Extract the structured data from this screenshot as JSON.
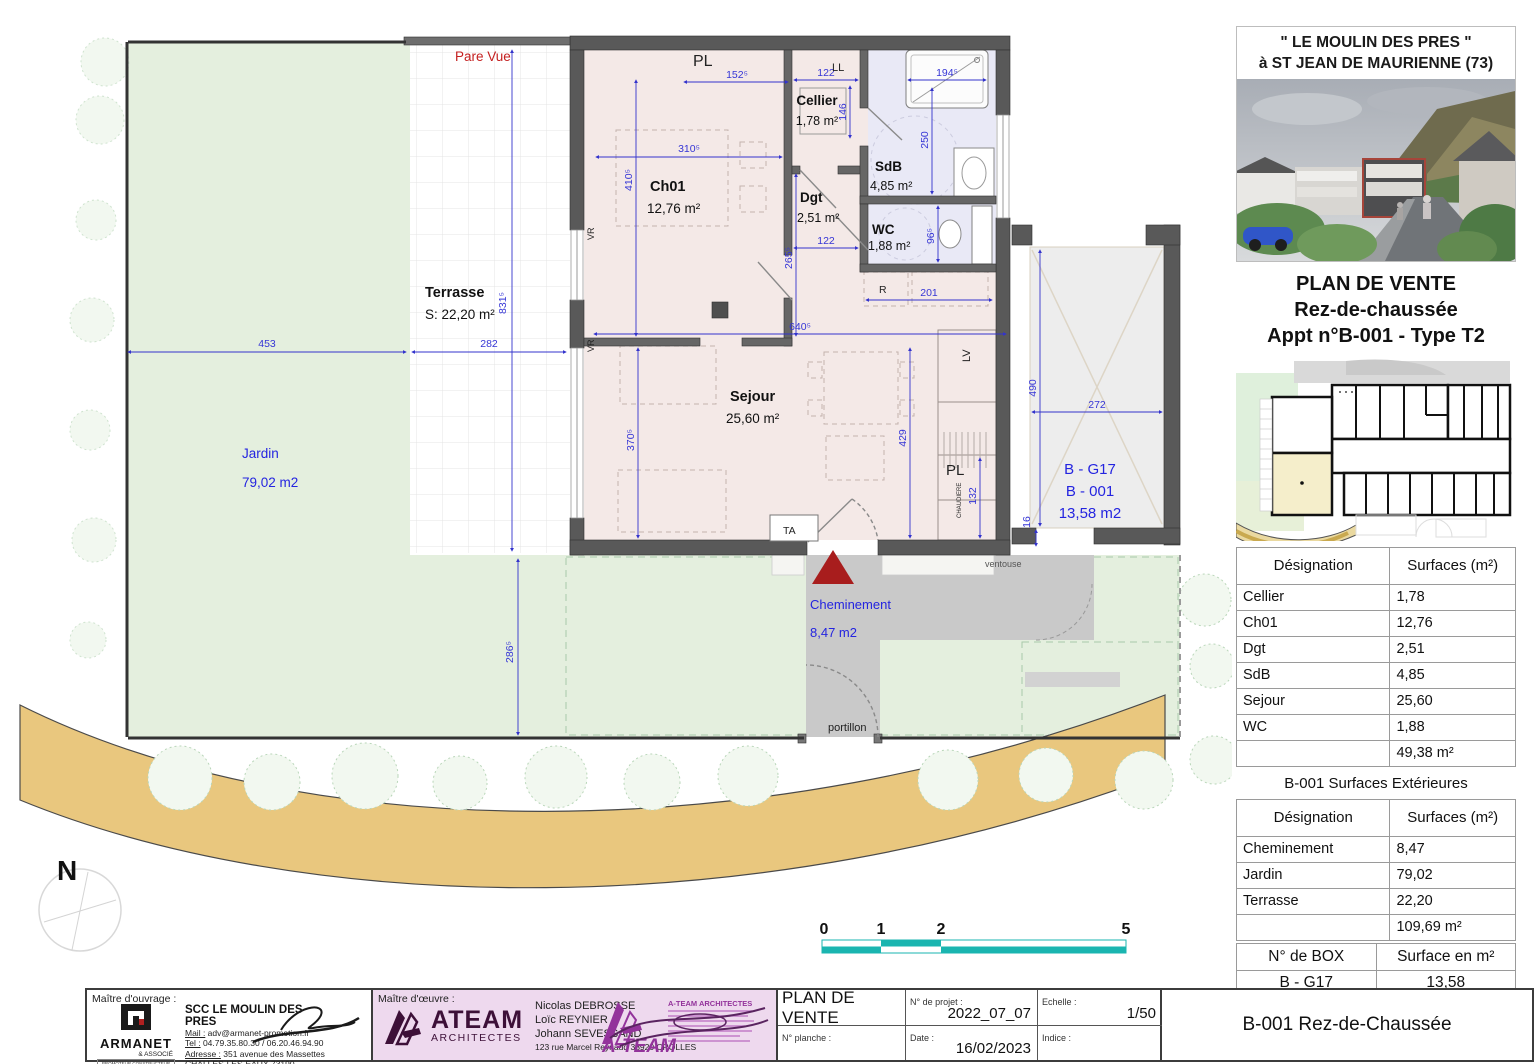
{
  "project": {
    "title_line1": "\" LE MOULIN DES PRES \"",
    "title_line2": "à ST JEAN DE MAURIENNE (73)",
    "doc_line1": "PLAN DE VENTE",
    "doc_line2": "Rez-de-chaussée",
    "doc_line3": "Appt n°B-001 - Type T2"
  },
  "plan": {
    "rooms": {
      "terrasse": {
        "name": "Terrasse",
        "area": "S: 22,20 m²"
      },
      "jardin": {
        "name": "Jardin",
        "area": "79,02 m2"
      },
      "ch01": {
        "name": "Ch01",
        "area": "12,76 m²"
      },
      "cellier": {
        "name": "Cellier",
        "area": "1,78 m²"
      },
      "dgt": {
        "name": "Dgt",
        "area": "2,51 m²"
      },
      "sdb": {
        "name": "SdB",
        "area": "4,85 m²"
      },
      "wc": {
        "name": "WC",
        "area": "1,88 m²"
      },
      "sejour": {
        "name": "Sejour",
        "area": "25,60 m²"
      },
      "box": {
        "line1": "B - G17",
        "line2": "B - 001",
        "line3": "13,58 m2"
      },
      "cheminement": {
        "name": "Cheminement",
        "area": "8,47 m2"
      }
    },
    "dims": {
      "jardin_w": "453",
      "terrasse_w": "282",
      "terrasse_h": "831⁵",
      "jardin_h2": "286⁵",
      "pl_w": "152⁵",
      "cellier_w": "122",
      "cellier_h": "146",
      "shower_w": "194⁵",
      "sdb_h": "250",
      "ch01_w": "310⁵",
      "ch01_h": "410⁵",
      "dgt_h": "265⁵",
      "dgt_w": "122",
      "wc_h": "96⁵",
      "wc_w": "201",
      "sejour_w": "640⁵",
      "sejour_h": "370⁵",
      "kitchen_h": "429",
      "kitchen_pl": "132",
      "box_h": "490",
      "box_w": "272",
      "box_gap": "16"
    },
    "misc": {
      "pare_vue": "Pare Vue",
      "pl": "PL",
      "ll": "LL",
      "lv": "LV",
      "r": "R",
      "ta": "TA",
      "vr": "VR",
      "chaudiere": "CHAUDIERE",
      "ventouse": "ventouse",
      "portillon": "portillon",
      "north": "N"
    },
    "scalebar": {
      "t0": "0",
      "t1": "1",
      "t2": "2",
      "t3": "5"
    }
  },
  "tables": {
    "interior": {
      "headers": [
        "Désignation",
        "Surfaces (m²)"
      ],
      "rows": [
        [
          "Cellier",
          "1,78"
        ],
        [
          "Ch01",
          "12,76"
        ],
        [
          "Dgt",
          "2,51"
        ],
        [
          "SdB",
          "4,85"
        ],
        [
          "Sejour",
          "25,60"
        ],
        [
          "WC",
          "1,88"
        ]
      ],
      "total": "49,38 m²"
    },
    "exterior_title": "B-001 Surfaces Extérieures",
    "exterior": {
      "headers": [
        "Désignation",
        "Surfaces (m²)"
      ],
      "rows": [
        [
          "Cheminement",
          "8,47"
        ],
        [
          "Jardin",
          "79,02"
        ],
        [
          "Terrasse",
          "22,20"
        ]
      ],
      "total": "109,69 m²"
    },
    "box": {
      "headers": [
        "N° de BOX",
        "Surface en m²"
      ],
      "row": [
        "B - G17",
        "13,58"
      ]
    }
  },
  "titleblock": {
    "owner": {
      "label": "Maître d'ouvrage :",
      "logo_name": "ARMANET",
      "logo_sub": "& ASSOCIÉ",
      "logo_tag": "PROMOTEUR CONSTRUCTEUR",
      "company": "SCC LE MOULIN DES PRES",
      "contact": [
        {
          "label": "Mail :",
          "value": " adv@armanet-promotion.fr"
        },
        {
          "label": "Tel :",
          "value": " 04.79.35.80.30 / 06.20.46.94.90"
        },
        {
          "label": "Adresse :",
          "value": " 351 avenue des Massettes"
        }
      ],
      "city": "CHALLES-LES-EAUX 73190",
      "website": "www.armanet-promotion.fr"
    },
    "architect": {
      "label": "Maître d'œuvre :",
      "logo_name": "ATEAM",
      "logo_sub": "ARCHITECTES",
      "names": [
        "Nicolas DEBROSSE",
        "Loïc REYNIER",
        "Johann SEVESSAND"
      ],
      "address": "123 rue Marcel Reynaud 38920 CROLLES",
      "stamp_title": "A-TEAM ARCHITECTES",
      "stamp_name": "A-TEAM"
    },
    "info": {
      "title": "PLAN DE VENTE",
      "projet_label": "N° de projet :",
      "projet": "2022_07_07",
      "echelle_label": "Echelle :",
      "echelle": "1/50",
      "planche_label": "N° planche :",
      "date_label": "Date :",
      "date": "16/02/2023",
      "indice_label": "Indice :",
      "sheet": "B-001 Rez-de-Chaussée"
    }
  },
  "colors": {
    "dim_blue": "#3333cc",
    "label_blue": "#2424e0",
    "red": "#b31d1d",
    "teal": "#1ab5b0",
    "jardin_green": "#e4efde",
    "floor_pink": "#f4e9e7",
    "bath_lavender": "#e9e9f6",
    "path_tan": "#e9c77e",
    "wall_gray": "#595959",
    "arch_pink": "#eed9ee",
    "stamp_purple": "#93339b"
  }
}
